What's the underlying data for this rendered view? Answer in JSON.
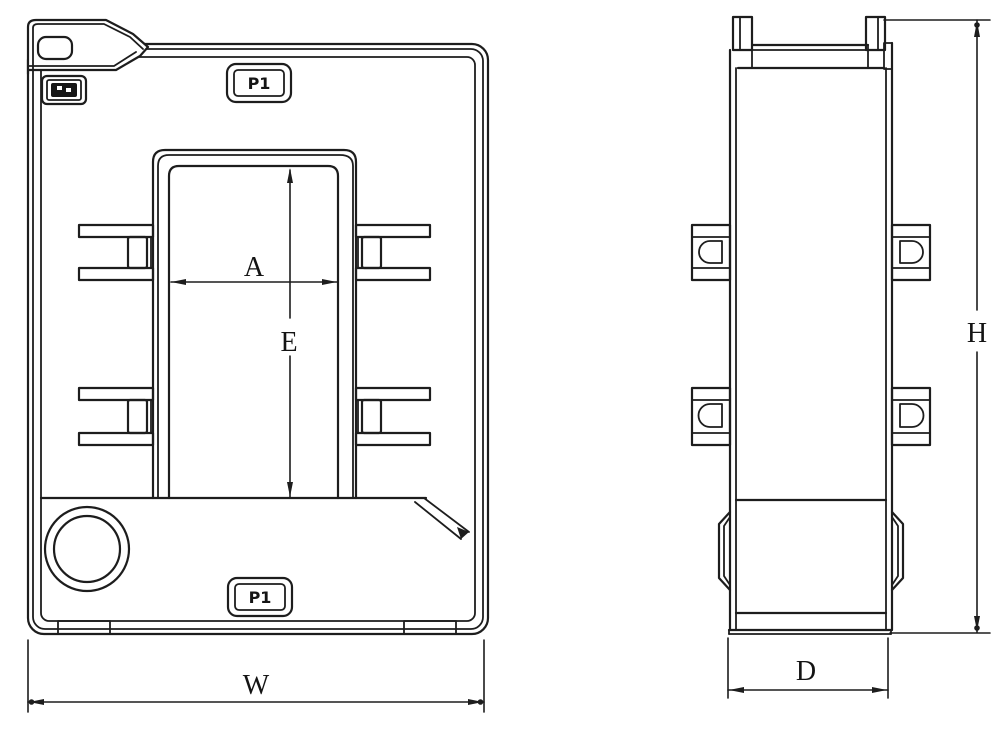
{
  "drawing": {
    "kind": "technical-outline-drawing-two-views",
    "colors": {
      "line": "#1d1d1d",
      "background": "#ffffff"
    },
    "emblems": {
      "top_left": "filled-mark-emblem"
    }
  },
  "front_view": {
    "badges": {
      "top": "P1",
      "bottom": "P1"
    },
    "dimensions": {
      "window_width": "A",
      "window_height": "E",
      "overall_width": "W"
    }
  },
  "side_view": {
    "dimensions": {
      "overall_height": "H",
      "depth": "D"
    }
  }
}
